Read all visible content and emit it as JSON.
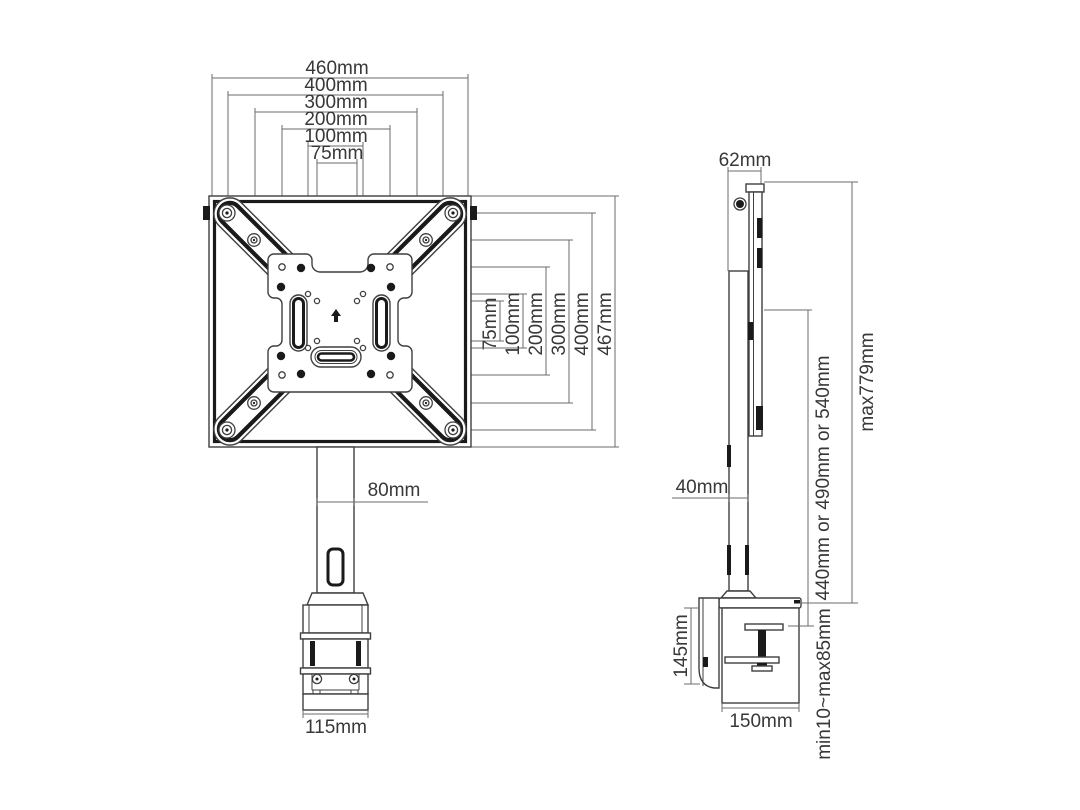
{
  "drawing": {
    "type": "technical-dimension-drawing",
    "subject": "monitor desk mount with VESA adapter plate, front and side views",
    "colors": {
      "background": "#ffffff",
      "dimension_line": "#6b6b6b",
      "part_outline": "#3f3f3f",
      "part_black": "#1a1a1a",
      "text": "#383838"
    },
    "front": {
      "width_dims": [
        "460mm",
        "400mm",
        "300mm",
        "200mm",
        "100mm",
        "75mm"
      ],
      "height_dims": [
        "75mm",
        "100mm",
        "200mm",
        "300mm",
        "400mm",
        "467mm"
      ],
      "pole_width": "80mm",
      "clamp_width": "115mm"
    },
    "side": {
      "head_depth": "62mm",
      "pole_depth": "40mm",
      "column_height": "440mm or 490mm or 540mm",
      "max_height": "max779mm",
      "clamp_height": "145mm",
      "clamp_depth": "150mm",
      "desk_thickness": "min10~max85mm"
    }
  }
}
